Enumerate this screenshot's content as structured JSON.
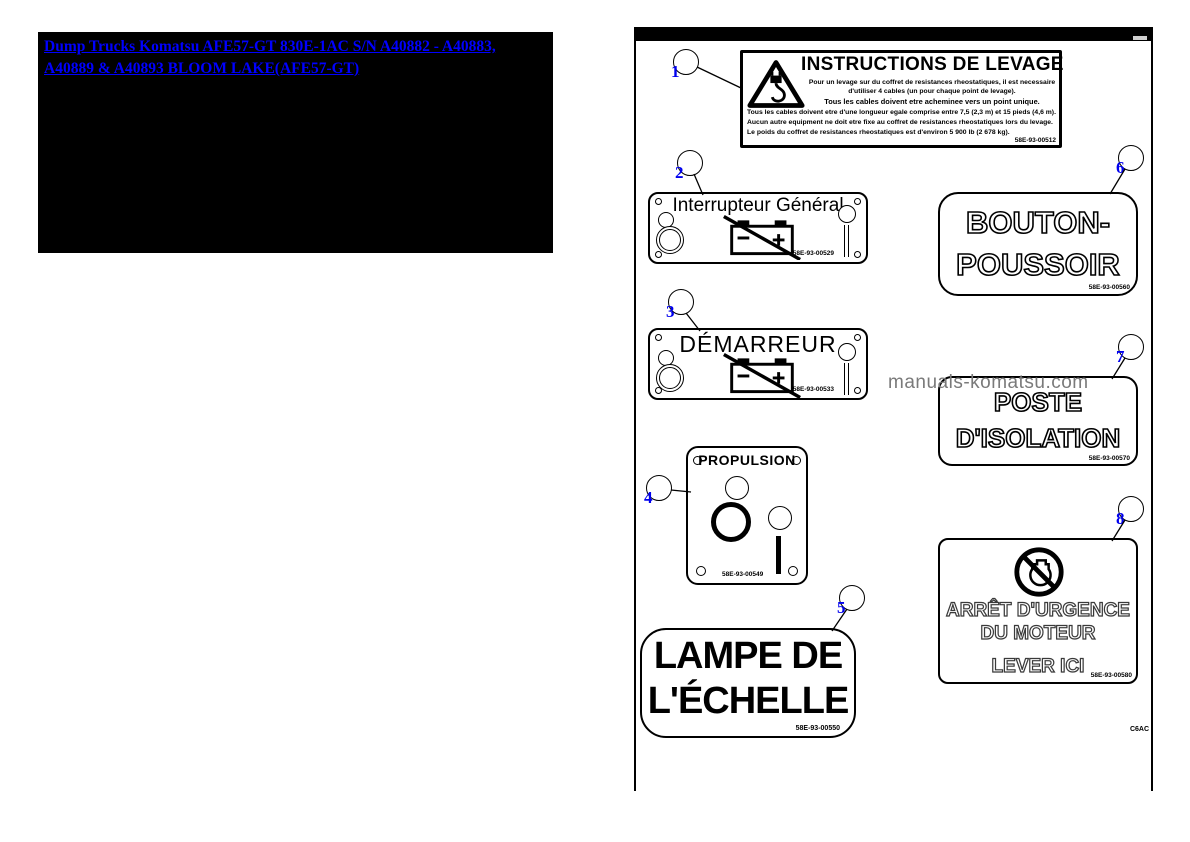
{
  "link_box": {
    "text": "Dump Trucks Komatsu AFE57-GT 830E-1AC S/N A40882 - A40883, A40889 & A40893 BLOOM LAKE(AFE57-GT)"
  },
  "watermark": {
    "text": "manuals-komatsu.com"
  },
  "panel": {
    "corner_code": "C6AC"
  },
  "callouts": [
    {
      "num": "1"
    },
    {
      "num": "2"
    },
    {
      "num": "3"
    },
    {
      "num": "4"
    },
    {
      "num": "5"
    },
    {
      "num": "6"
    },
    {
      "num": "7"
    },
    {
      "num": "8"
    }
  ],
  "labels": {
    "levage": {
      "title": "INSTRUCTIONS DE LEVAGE",
      "line1": "Pour un levage sur du coffret de resistances rheostatiques, il est necessaire",
      "line2": "d'utiliser 4 cables (un pour chaque point de levage).",
      "line3": "Tous les cables doivent etre acheminee vers un point unique.",
      "line4": "Tous les cables doivent etre d'une longueur egale comprise entre 7,5 (2,3 m) et 15 pieds (4,6 m).",
      "line5": "Aucun autre equipment ne doit etre fixe au coffret de resistances rheostatiques lors du levage.",
      "line6": "Le poids du coffret de resistances rheostatiques est d'environ 5 900 lb (2 678 kg).",
      "part": "58E-93-00512"
    },
    "interrupteur": {
      "title": "Interrupteur Général",
      "part": "58E-93-00529"
    },
    "demarreur": {
      "title": "DÉMARREUR",
      "part": "58E-93-00533"
    },
    "propulsion": {
      "title": "PROPULSION",
      "part": "58E-93-00549"
    },
    "lampe": {
      "line1": "LAMPE DE",
      "line2": "L'ÉCHELLE",
      "part": "58E-93-00550"
    },
    "bouton": {
      "line1": "BOUTON-",
      "line2": "POUSSOIR",
      "part": "58E-93-00560"
    },
    "poste": {
      "line1": "POSTE",
      "line2": "D'ISOLATION",
      "part": "58E-93-00570"
    },
    "arret": {
      "line1": "ARRÊT D'URGENCE",
      "line2": "DU MOTEUR",
      "line3": "LEVER ICI",
      "part": "58E-93-00580"
    }
  },
  "colors": {
    "link_blue": "#0000ff",
    "callout_number_blue": "#0000ee",
    "watermark_gray": "#7a7a7a"
  }
}
